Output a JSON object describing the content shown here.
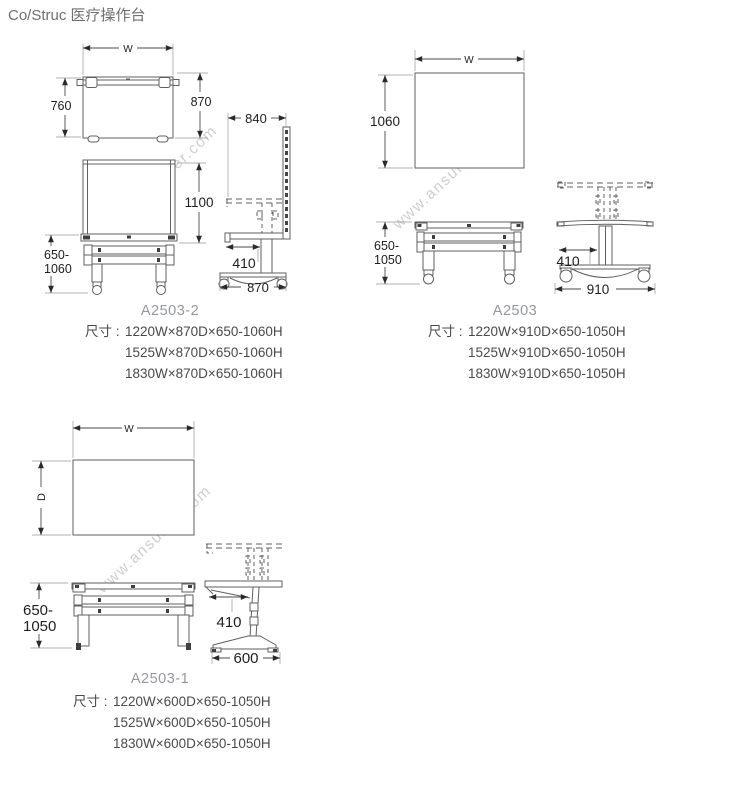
{
  "page_title": "Co/Struc 医疗操作台",
  "watermark_text": "www.ansuner.com",
  "panels": [
    {
      "model": "A2503-2",
      "size_prefix": "尺寸 :",
      "sizes": [
        "1220W×870D×650-1060H",
        "1525W×870D×650-1060H",
        "1830W×870D×650-1060H"
      ],
      "dims": {
        "w": "W",
        "top_depth": "760",
        "overall_depth": "870",
        "board_width": "840",
        "board_height": "1100",
        "height_range_line1": "650-",
        "height_range_line2": "1060",
        "reach": "410",
        "base_depth": "870"
      }
    },
    {
      "model": "A2503",
      "size_prefix": "尺寸 :",
      "sizes": [
        "1220W×910D×650-1050H",
        "1525W×910D×650-1050H",
        "1830W×910D×650-1050H"
      ],
      "dims": {
        "w": "W",
        "top_depth": "1060",
        "height_range_line1": "650-",
        "height_range_line2": "1050",
        "reach": "410",
        "base_depth": "910"
      }
    },
    {
      "model": "A2503-1",
      "size_prefix": "尺寸 :",
      "sizes": [
        "1220W×600D×650-1050H",
        "1525W×600D×650-1050H",
        "1830W×600D×650-1050H"
      ],
      "dims": {
        "w": "W",
        "d": "D",
        "height_range_line1": "650-",
        "height_range_line2": "1050",
        "reach": "410",
        "base_depth": "600"
      }
    }
  ]
}
